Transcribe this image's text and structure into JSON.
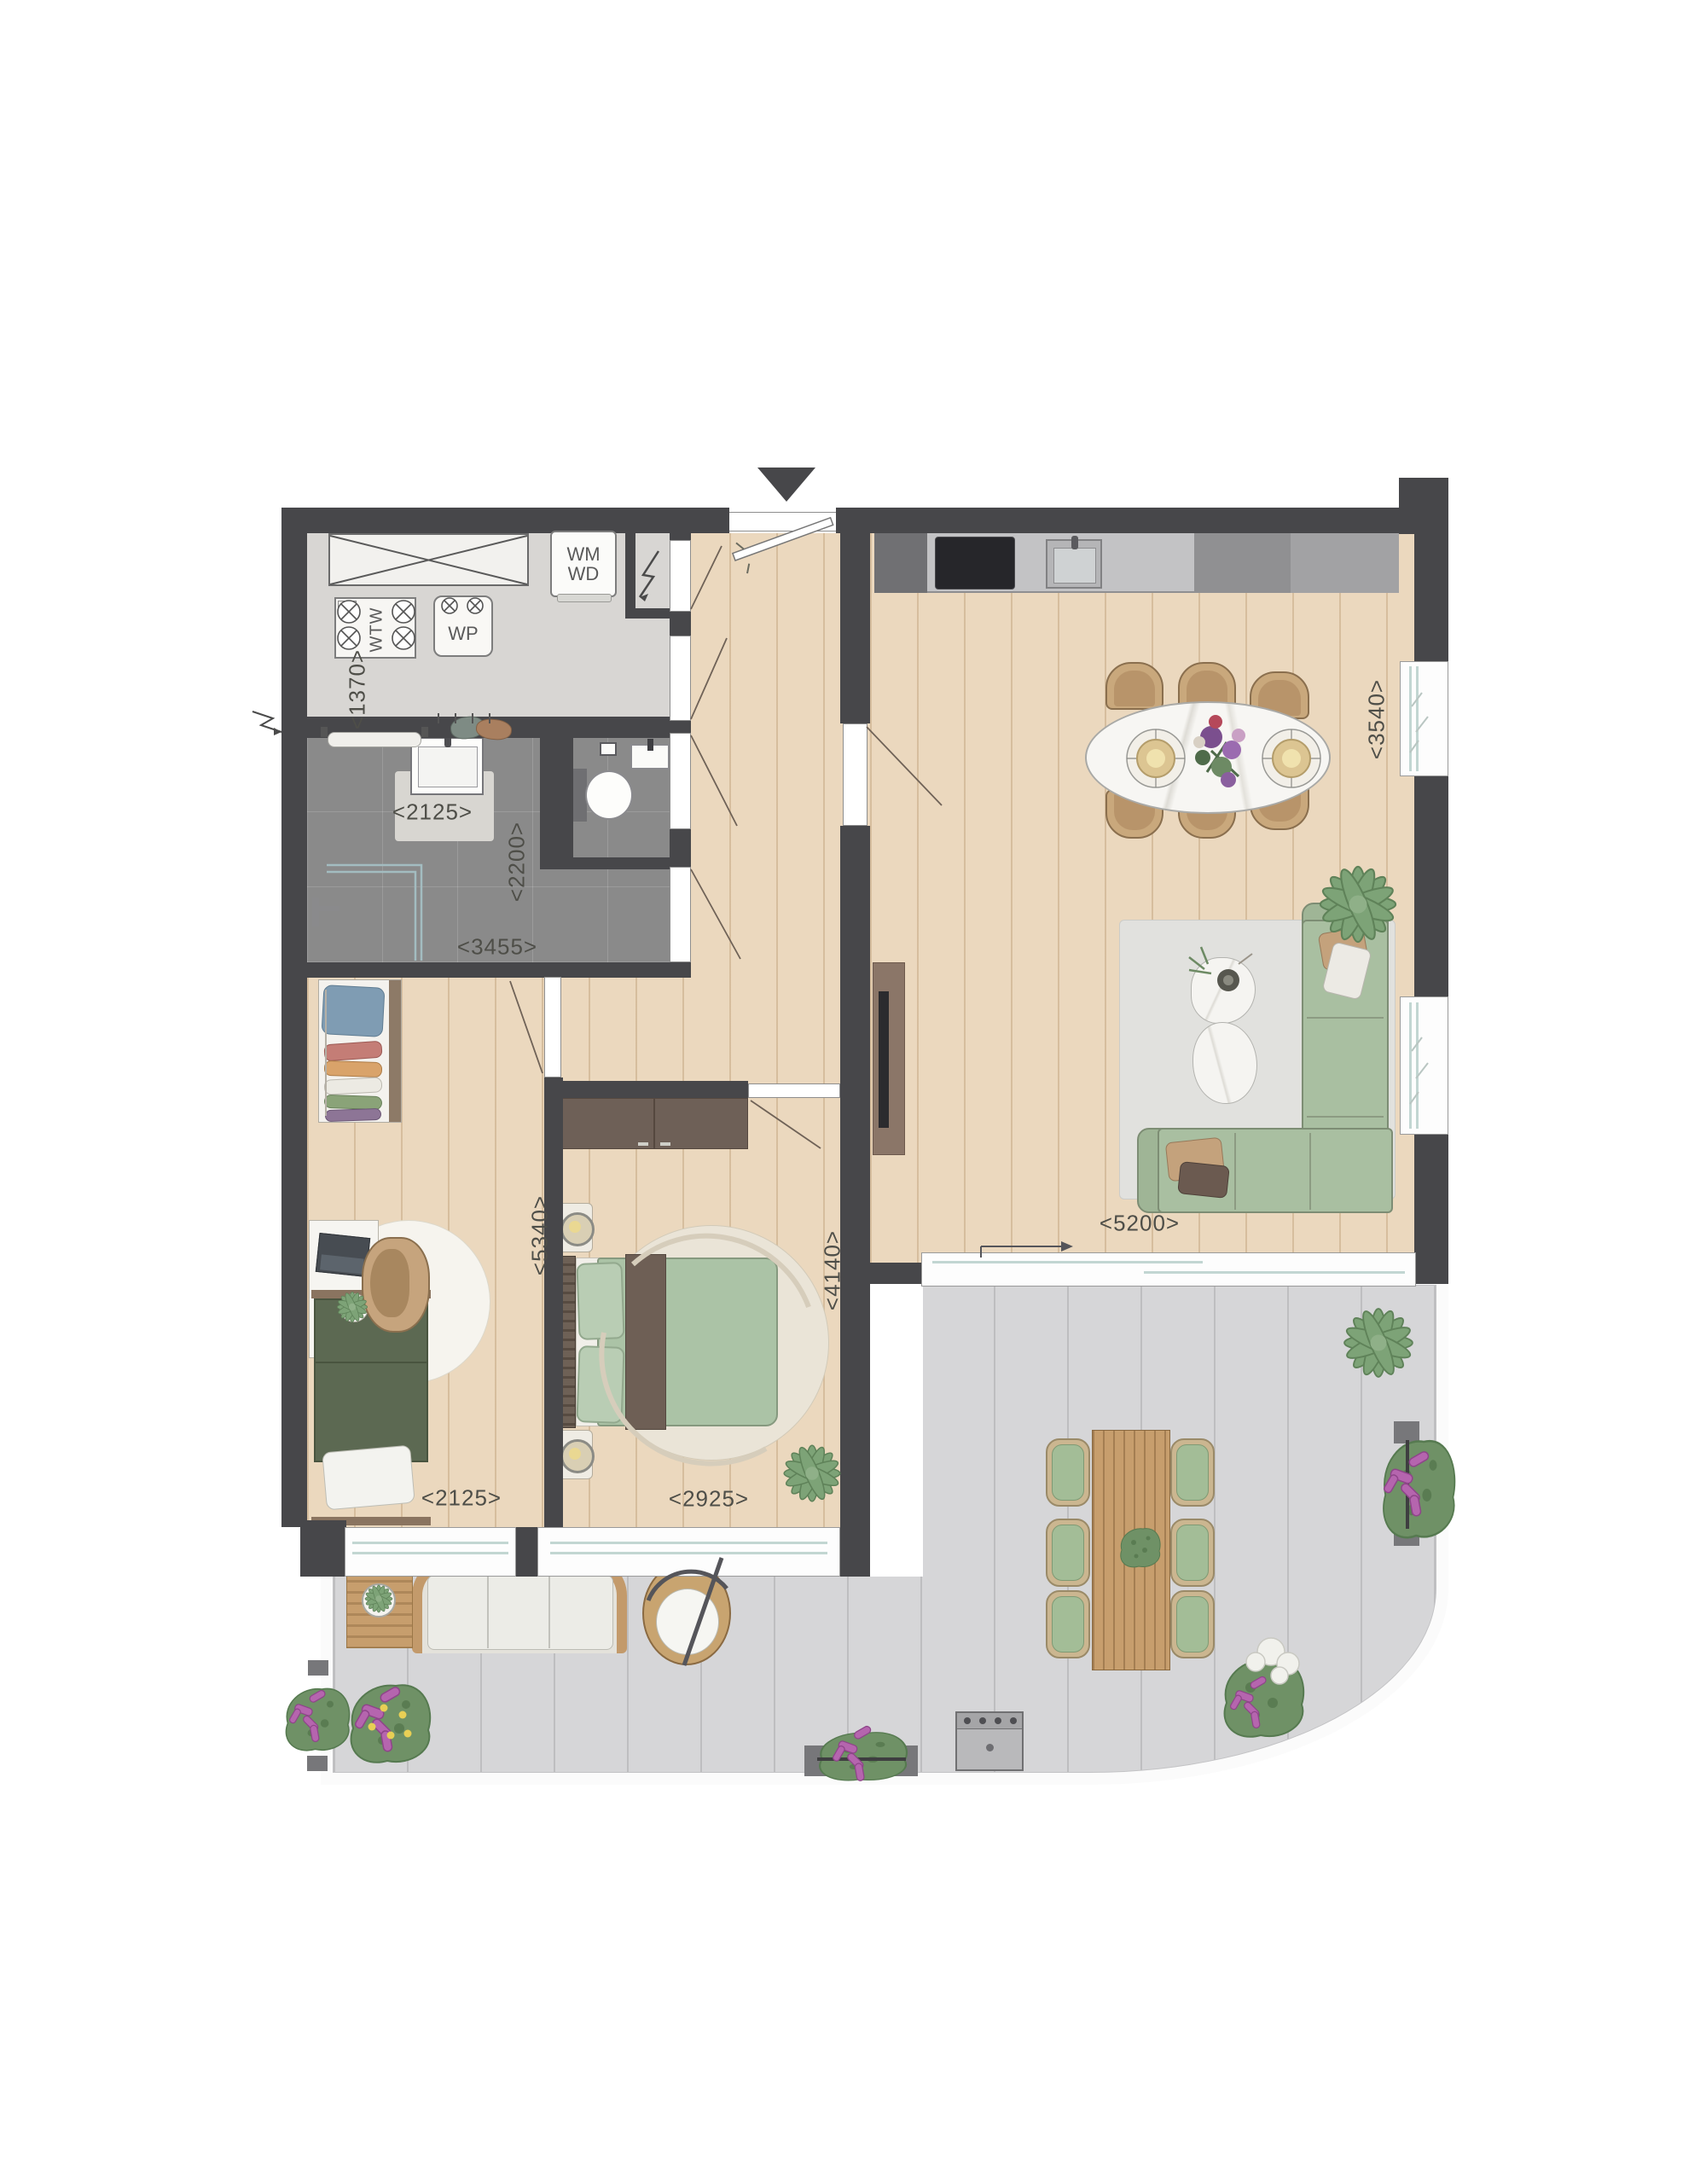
{
  "appliance_labels": {
    "washer_line1": "WM",
    "washer_line2": "WD",
    "heat_recovery": "WTW",
    "heat_pump": "WP"
  },
  "dimension_labels": {
    "storage_width": "<1370>",
    "bath_vanity_width": "<2125>",
    "bathroom_depth": "<2200>",
    "bathroom_width": "<3455>",
    "bedroom2_width": "<2125>",
    "bedroom2_length": "<5340>",
    "bedroom1_width": "<2925>",
    "bedroom1_length": "<4140>",
    "living_room_width": "<5200>",
    "living_room_depth": "<3540>"
  },
  "colors": {
    "wall": "#47474a",
    "wood_floor": "#ebd8be",
    "bathroom_tile": "#8a8a8a",
    "terrace_deck": "#d6d6d8",
    "sofa_green": "#a9bfa1",
    "flower_purple": "#b565ae"
  }
}
